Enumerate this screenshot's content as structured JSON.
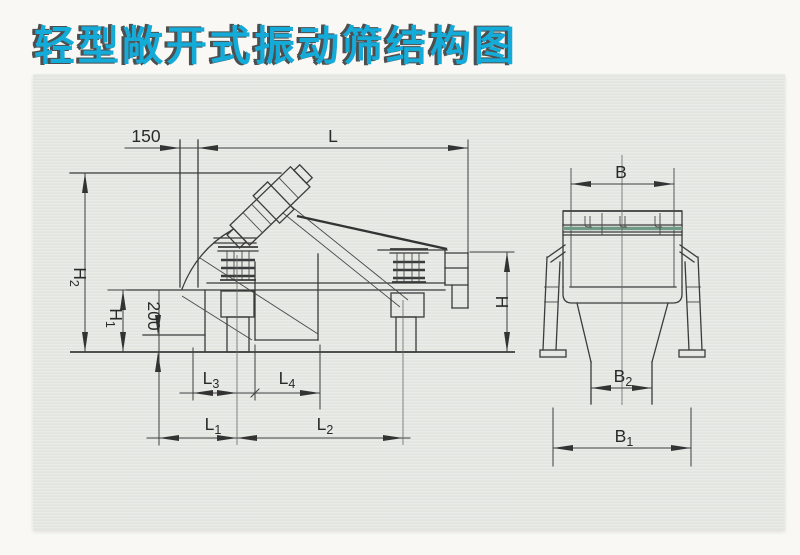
{
  "title": {
    "text": "轻型敞开式振动筛结构图",
    "color": "#14abd9",
    "shadow_color": "#4e4e4e"
  },
  "side_view": {
    "dim_labels": {
      "offset": "150",
      "length": "L",
      "h2": {
        "main": "H",
        "sub": "2"
      },
      "h1": {
        "main": "H",
        "sub": "1"
      },
      "depth": "200",
      "height": "H",
      "l3": {
        "main": "L",
        "sub": "3"
      },
      "l4": {
        "main": "L",
        "sub": "4"
      },
      "l1": {
        "main": "L",
        "sub": "1"
      },
      "l2": {
        "main": "L",
        "sub": "2"
      }
    }
  },
  "front_view": {
    "dim_labels": {
      "b": "B",
      "b2": {
        "main": "B",
        "sub": "2"
      },
      "b1": {
        "main": "B",
        "sub": "1"
      }
    }
  },
  "colors": {
    "mesh_line": "#6f9a86",
    "draw_line": "#3b3b3b",
    "dim_text": "#2a2a2a"
  }
}
